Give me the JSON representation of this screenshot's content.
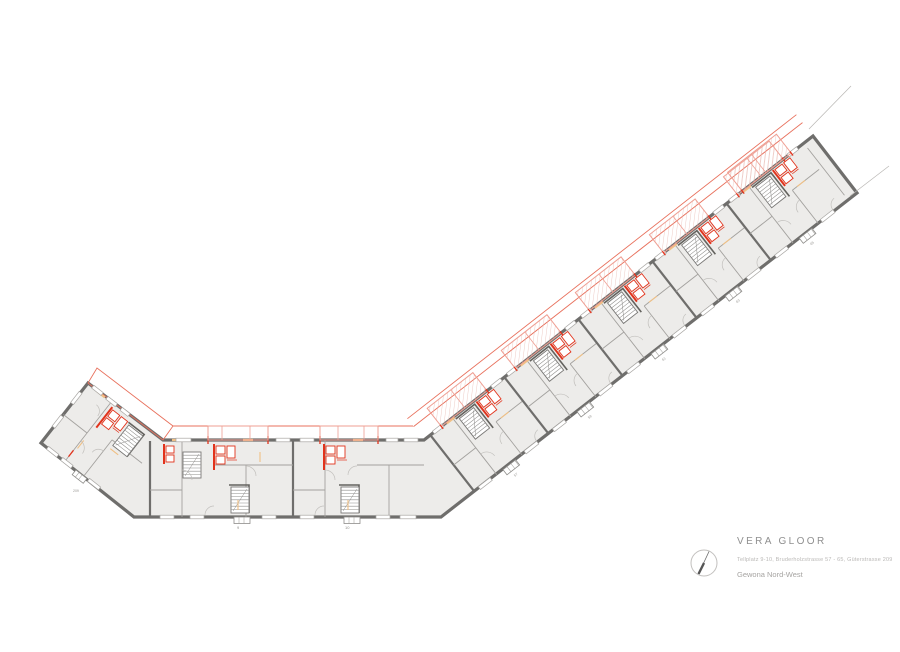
{
  "title_block": {
    "architect": "VERA GLOOR",
    "address": "Tellplatz 9-10, Bruderholzstrasse 57 - 65, Güterstrasse 209",
    "project": "Gewona Nord-West"
  },
  "plan": {
    "drawing_type": "floor-plan",
    "entrance_numbers": {
      "left_wing": "209",
      "middle": [
        "9",
        "10"
      ],
      "right_wing": [
        "57",
        "59",
        "61",
        "63",
        "65"
      ]
    }
  },
  "icons": {
    "north_arrow": "north-arrow-icon"
  },
  "colors": {
    "wall_gray": "#6f6e6c",
    "floor_fill": "#edecea",
    "demolition_red": "#e2331c",
    "balcony_red": "#ef9f93",
    "door_orange": "#f1c084"
  }
}
